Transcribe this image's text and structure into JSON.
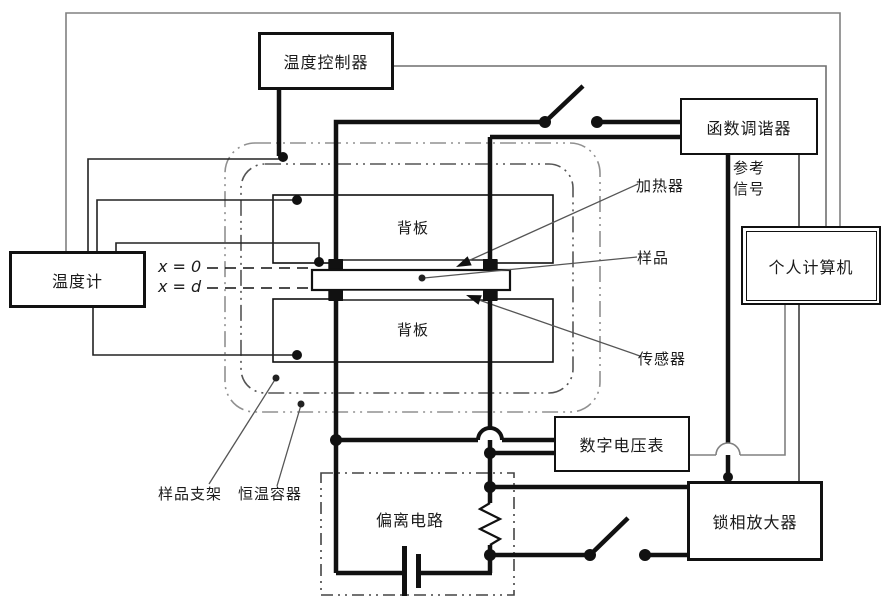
{
  "diagram": {
    "boxes": {
      "temp_controller": "温度控制器",
      "function_generator": "函数调谐器",
      "thermometer": "温度计",
      "personal_computer": "个人计算机",
      "digital_voltmeter": "数字电压表",
      "lockin_amplifier": "锁相放大器",
      "bias_circuit": "偏离电路",
      "backplane_top": "背板",
      "backplane_bottom": "背板"
    },
    "annotations": {
      "heater": "加热器",
      "sample": "样品",
      "sensor": "传感器",
      "reference_signal": "参考\n信号",
      "sample_holder": "样品支架",
      "thermostat_container": "恒温容器",
      "x_zero": "x = 0",
      "x_d": "x = d"
    },
    "colors": {
      "wire": "#111111",
      "loop_line": "#808080",
      "container_outer": "#909090",
      "container_inner": "#555555"
    }
  }
}
